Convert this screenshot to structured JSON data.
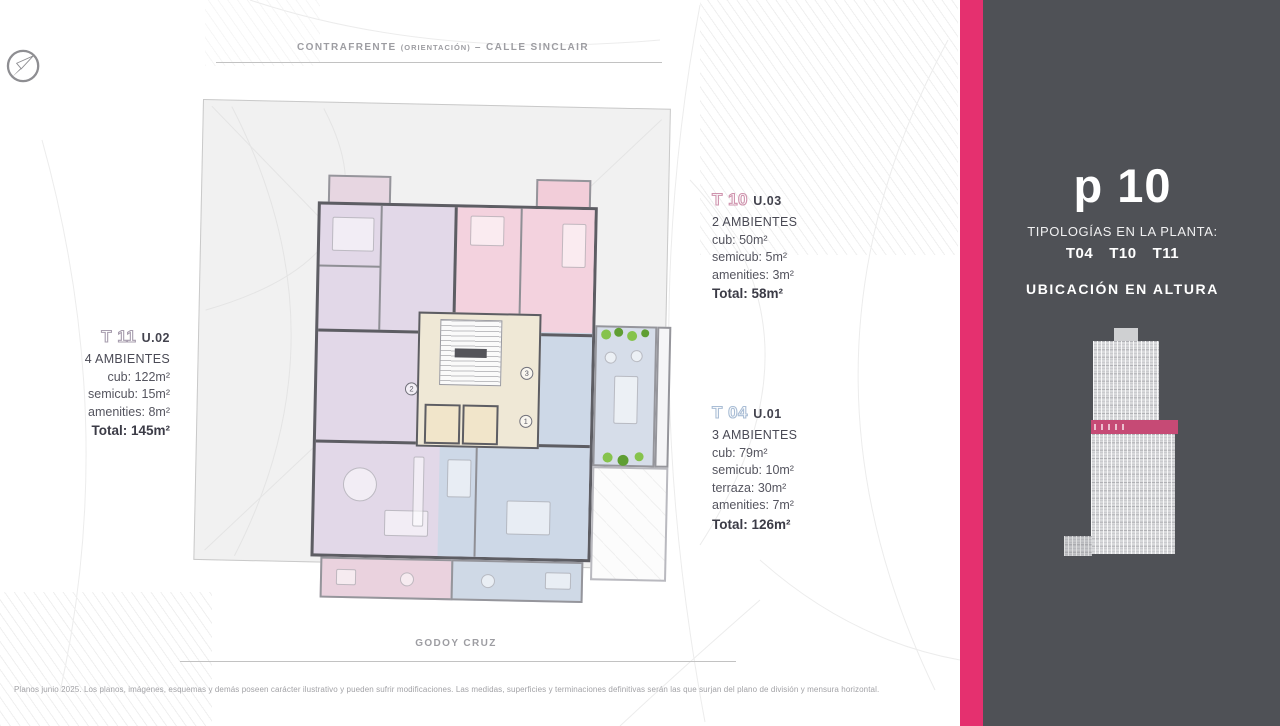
{
  "streets": {
    "contrafrente": "CONTRAFRENTE ",
    "contrafrente_note": "(ORIENTACIÓN)",
    "contrafrente_suffix": " – CALLE SINCLAIR",
    "godoy_cruz": "GODOY CRUZ"
  },
  "units": [
    {
      "code": "T 11",
      "unit": "U.02",
      "rooms": "4 AMBIENTES",
      "lines": [
        "cub: 122m²",
        "semicub: 15m²",
        "amenities: 8m²"
      ],
      "total": "Total: 145m²",
      "outline_color": "#a79dae"
    },
    {
      "code": "T 10",
      "unit": "U.03",
      "rooms": "2 AMBIENTES",
      "lines": [
        "cub: 50m²",
        "semicub: 5m²",
        "amenities: 3m²"
      ],
      "total": "Total: 58m²",
      "outline_color": "#cf93ad"
    },
    {
      "code": "T 04",
      "unit": "U.01",
      "rooms": "3 AMBIENTES",
      "lines": [
        "cub: 79m²",
        "semicub: 10m²",
        "terraza: 30m²",
        "amenities: 7m²"
      ],
      "total": "Total: 126m²",
      "outline_color": "#a9bdd5"
    }
  ],
  "plan_markers": {
    "t11": "2",
    "t10": "3",
    "t04": "1"
  },
  "panel": {
    "floor_label": "p 10",
    "typologies_title": "TIPOLOGÍAS EN LA PLANTA:",
    "typologies": [
      "T04",
      "T10",
      "T11"
    ],
    "height_title": "UBICACIÓN EN ALTURA"
  },
  "footer": {
    "disclaimer": "Planos junio 2025. Los planos, imágenes, esquemas y demás poseen carácter ilustrativo y pueden sufrir modificaciones. Las medidas, superficies y terminaciones definitivas serán las que surjan del plano de división y mensura horizontal."
  },
  "icons": {
    "compass": "compass-north-east-needle"
  },
  "colors": {
    "accent_stripe": "#e5306f",
    "panel_bg": "#4f5156",
    "building_band": "#c64a75",
    "unit_t11_fill": "#e2d8e8",
    "unit_t11_dark": "#ddd2e4",
    "unit_t10_fill": "#f3d2de",
    "unit_t10_light": "#f6dde6",
    "unit_t04_fill": "#cdd8e7",
    "core_fill": "#efe8d6",
    "elevator_fill": "#f1e5ca",
    "terrace_fill": "#d6dde9",
    "balcony_tl_fill": "#e7d6e1",
    "balcony_tr_fill": "#f2cdd9",
    "balcony_bl_fill": "#ead2de",
    "balcony_br_fill": "#cfd9e6",
    "plant_green": "#86c34c",
    "plant_green_dark": "#5f9e33"
  }
}
